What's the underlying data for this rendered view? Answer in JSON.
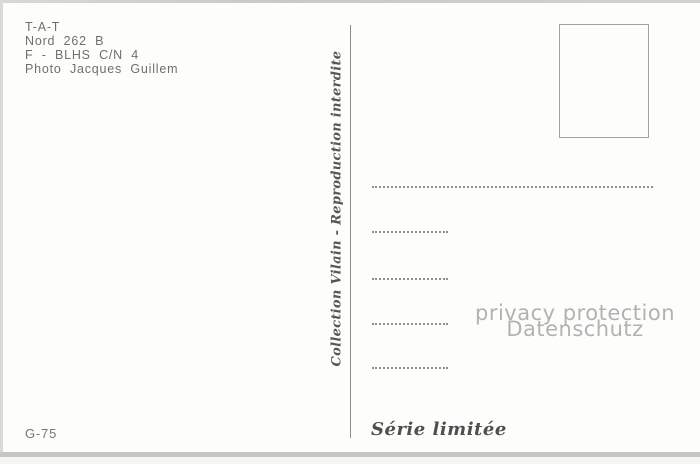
{
  "postcard": {
    "publisher": {
      "lines": [
        "T-A-T",
        "Nord 262 B",
        "F - BLHS C/N 4",
        "Photo Jacques Guillem"
      ]
    },
    "divider_note": "Collection Vilain - Reproduction interdite",
    "watermark": {
      "line1": "privacy protection",
      "line2": "Datenschutz"
    },
    "code": "G-75",
    "series_label": "Série limitée",
    "address_lines_count": 5
  },
  "colors": {
    "card_background": "#fdfdfc",
    "publisher_text": "#6f6f6f",
    "script_text": "#565656",
    "watermark_text": "#b2b2b2",
    "dotted_line": "#8f8f8f",
    "divider_line": "#8c8c8c",
    "stamp_border": "#a2a2a0"
  }
}
